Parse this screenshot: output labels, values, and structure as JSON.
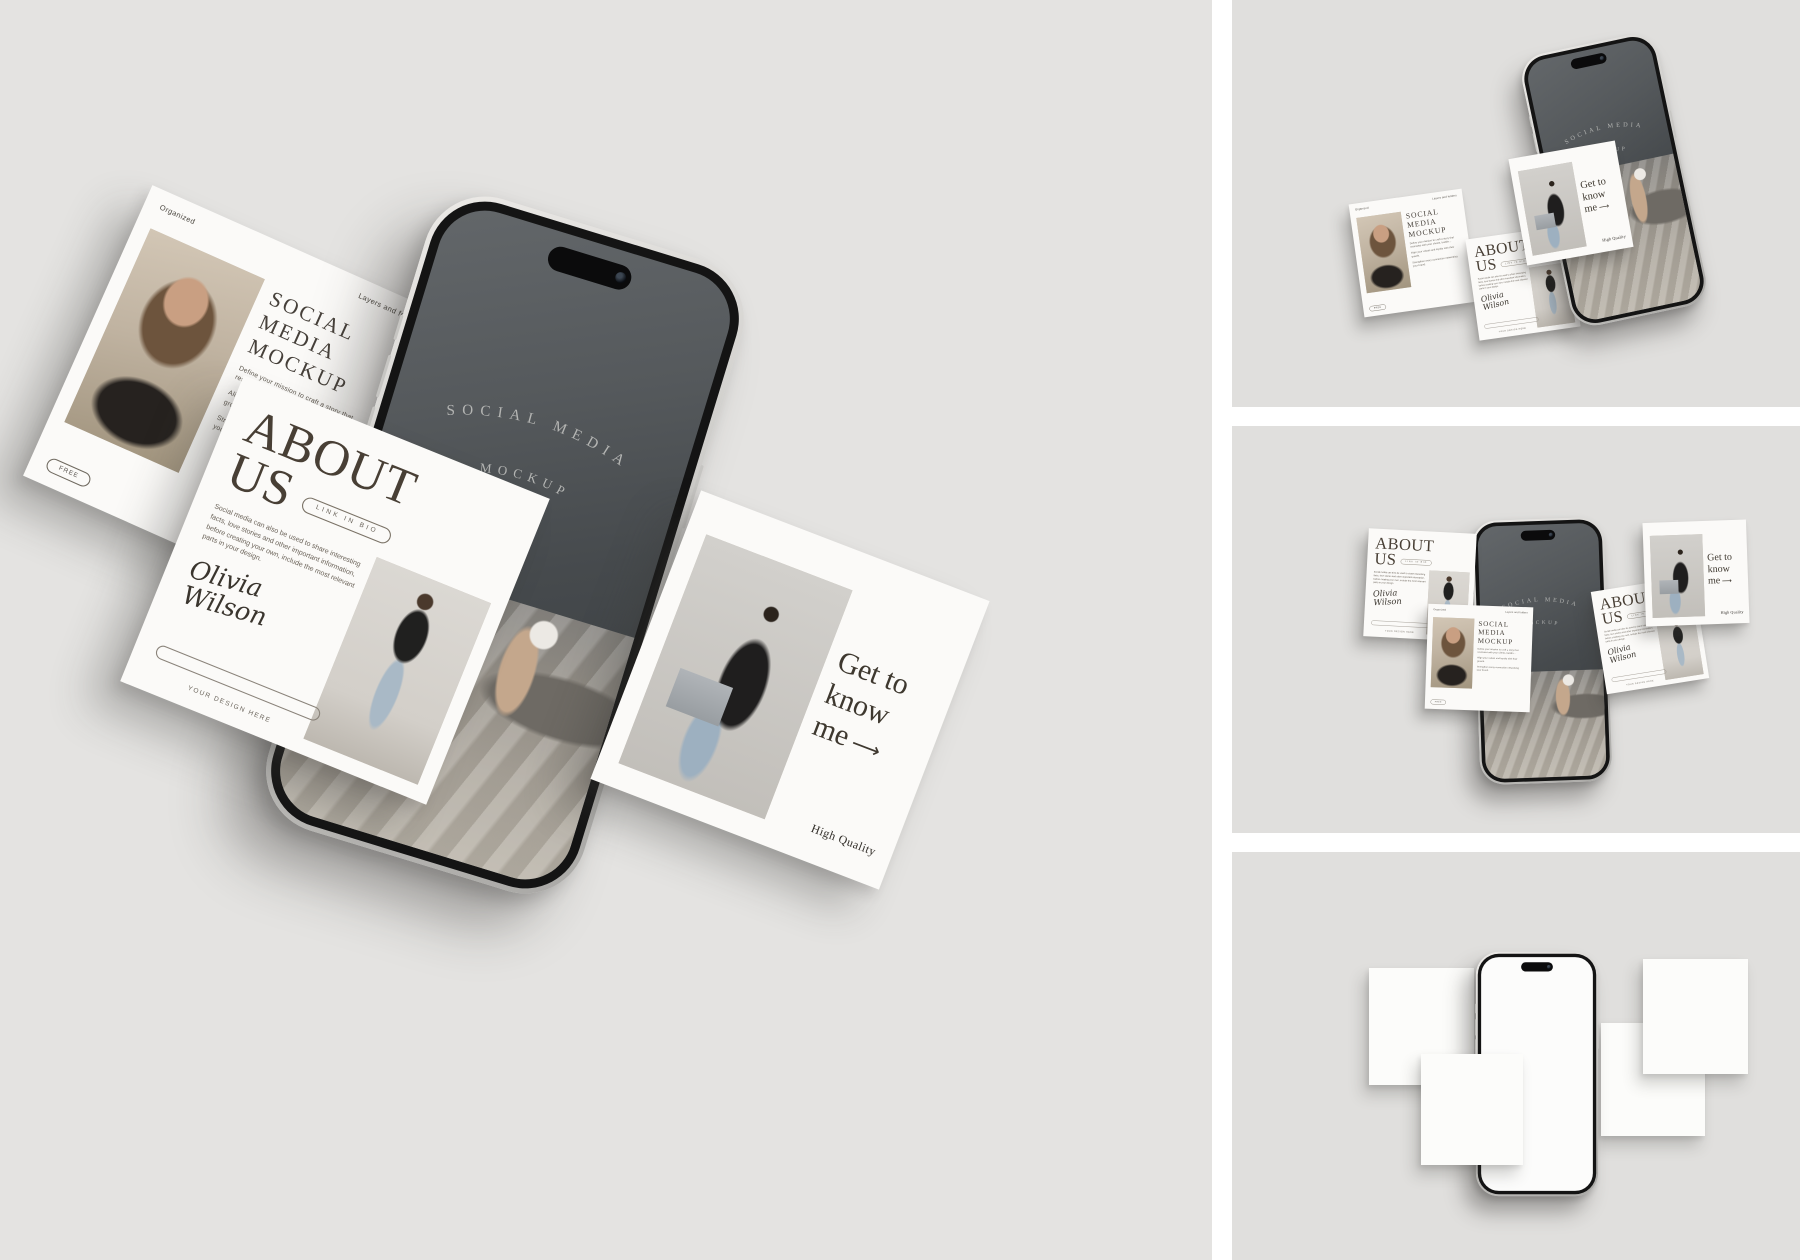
{
  "posts": {
    "social": {
      "badge_left": "Organized",
      "badge_right": "Layers and folders",
      "title": "SOCIAL MEDIA MOCKUP",
      "body_1": "Define your mission to craft a story that resonates with your clients, buildin...",
      "body_2": "Align your values and loyalty with their growth.",
      "body_3": "Strengthen every connection networking your brand.",
      "button_label": "FREE"
    },
    "about": {
      "title_1": "ABOUT",
      "title_2": "US",
      "pill_label": "LINK IN BIO",
      "body": "Social media can also be used to share interesting facts, love stories and other important information, before creating your own, include the most relevant parts in your design.",
      "signature": "Olivia Wilson",
      "footer_label": "YOUR DESIGN HERE"
    },
    "know": {
      "title_1": "Get to",
      "title_2": "know",
      "title_3": "me",
      "arrow": "⟶",
      "badge": "High Quality"
    }
  },
  "phone": {
    "screen_line1": "SOCIAL MEDIA",
    "screen_line2": "MOCKUP"
  },
  "colors": {
    "left_panel_bg": "#e4e3e1",
    "right_panel_bg": "#e0dfdd",
    "gutter": "#ffffff",
    "card_bg": "#fbfaf8",
    "ink": "#46403a",
    "phone_screen_dark": "#464a4d"
  }
}
